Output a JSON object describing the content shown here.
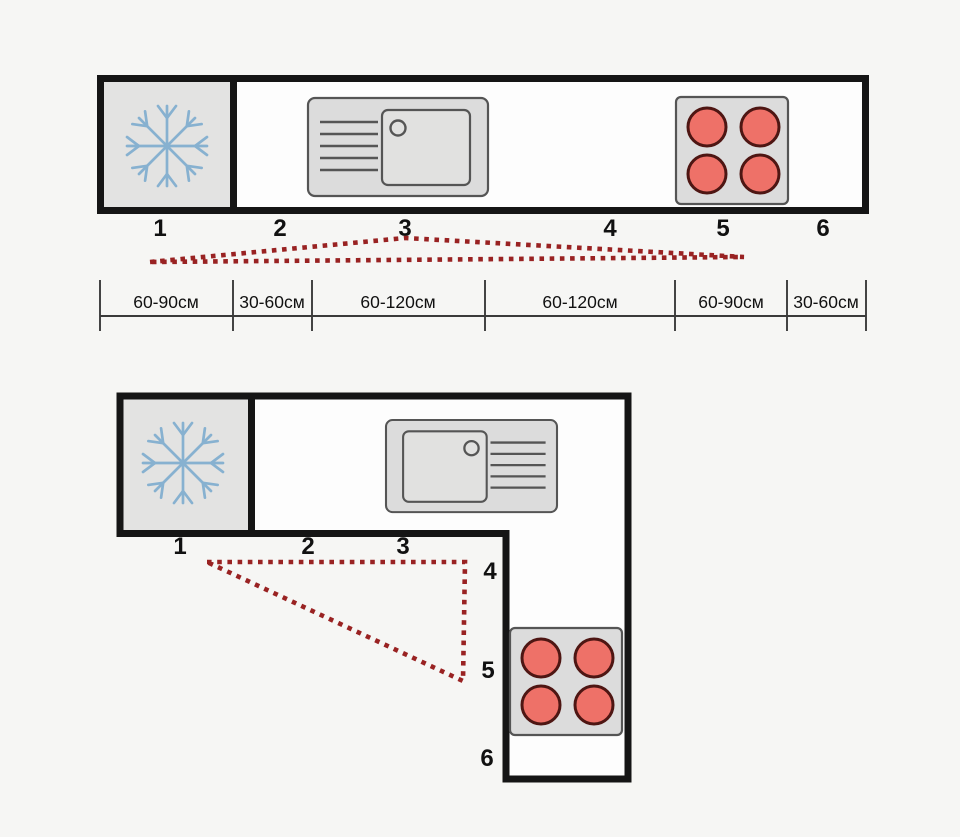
{
  "linear_layout": {
    "zones": [
      "1",
      "2",
      "3",
      "4",
      "5",
      "6"
    ],
    "dimensions": [
      "60-90см",
      "30-60см",
      "60-120см",
      "60-120см",
      "60-90см",
      "30-60см"
    ],
    "icons": {
      "fridge": "snowflake-icon",
      "sink": "sink-with-drainboard-icon",
      "stove": "four-burner-hob-icon"
    }
  },
  "l_shaped_layout": {
    "zones": [
      "1",
      "2",
      "3",
      "4",
      "5",
      "6"
    ],
    "icons": {
      "fridge": "snowflake-icon",
      "sink": "sink-with-drainboard-icon",
      "stove": "four-burner-hob-icon"
    }
  },
  "colors": {
    "background": "#f6f6f4",
    "outline": "#151515",
    "counter_fill": "#fdfdfd",
    "fridge_fill": "#e3e3e2",
    "appliance_fill": "#dcdcdc",
    "basin_fill": "#e1e1e0",
    "appliance_stroke": "#555555",
    "burner_fill": "#ee7168",
    "burner_stroke": "#4e1613",
    "snowflake_blue": "#87b1d0",
    "triangle_red": "#992222",
    "dim_line": "#3a3a3a",
    "text": "#111111"
  }
}
